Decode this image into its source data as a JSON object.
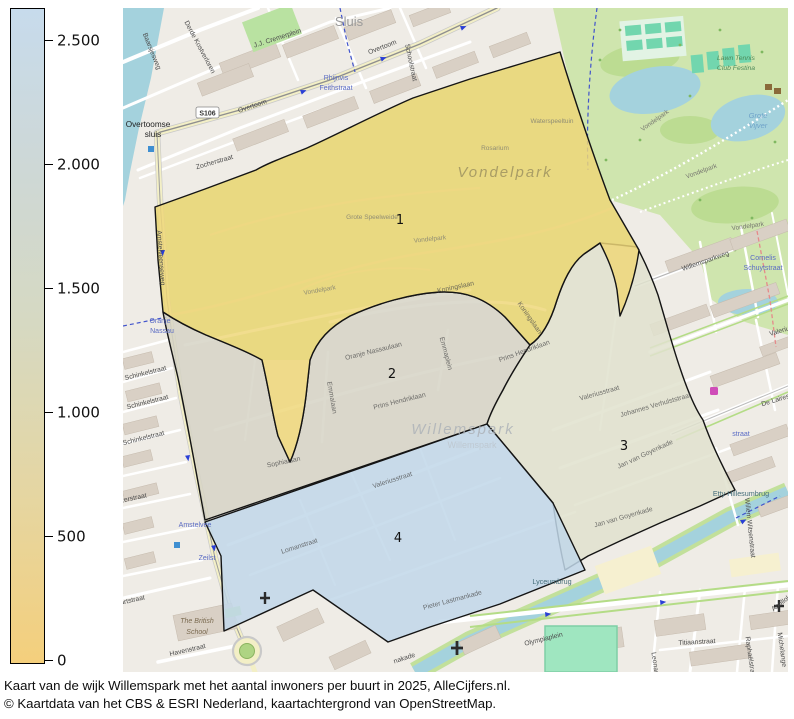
{
  "legend": {
    "min": 0,
    "max": 2500,
    "ticks": [
      {
        "label": "2.500"
      },
      {
        "label": "2.000"
      },
      {
        "label": "1.500"
      },
      {
        "label": "1.000"
      },
      {
        "label": "500"
      },
      {
        "label": "0"
      }
    ],
    "gradient_top_color": "#c7dbec",
    "gradient_bottom_color": "#f4cf7c"
  },
  "caption": {
    "line1": "Kaart van de wijk Willemspark met het aantal inwoners per buurt in 2025, AlleCijfers.nl.",
    "line2": "© Kaartdata van het CBS & ESRI Nederland, kaartachtergrond van OpenStreetMap."
  },
  "regions": {
    "r1": {
      "number": "1",
      "color": "#eed878"
    },
    "r2": {
      "number": "2",
      "color": "#d6d4c5"
    },
    "r3": {
      "number": "3",
      "color": "#e0e2ce"
    },
    "r4": {
      "number": "4",
      "color": "#c1d7e9"
    }
  },
  "map": {
    "shields": {
      "s106": "S106"
    },
    "labels": {
      "sluis": "Sluis",
      "overtoomse_sluis_1": "Overtoomse",
      "overtoomse_sluis_2": "sluis",
      "overtoom_a": "Overtoom",
      "overtoom_b": "Overtoom",
      "rhijnvis_1": "Rhijnvis",
      "rhijnvis_2": "Feithstraat",
      "jj_cremerplein": "J.J. Cremerplein",
      "baarsjesweg": "Baarsjesweg",
      "derde_kostverloren": "Derde Kostverloren",
      "schoolstraat": "Schoolstraat",
      "zocherstraat": "Zocherstraat",
      "amstelveenseweg": "Amstelveenseweg",
      "schinkelstraat_1": "Schinkelstraat",
      "schinkelstraat_2": "Schinkelstraat",
      "schinkelstraat_3": "Schinkelstraat",
      "zerstraat": "zerstraat",
      "oranje_1": "Oranje",
      "nassau_2": "Nassau",
      "amstelveen_blue": "Amstelvee",
      "zeilstraat": "Zeilst",
      "british_1": "The British",
      "british_2": "School",
      "havenstraat": "Havenstraat",
      "artstraat": "artstraat",
      "nakade": "nakade",
      "olympiaplein": "Olympiaplein",
      "titiaanstraat": "Titiaanstraat",
      "raphaelstraat": "Raphaëlstra",
      "michelangelostraat": "Michelange",
      "apollolaan": "Apollola",
      "leonardostraat": "Leonar",
      "willem_witsenstraat": "Willem Witsenstraat",
      "etty_hillesumbrug": "Etty Hillesumbrug",
      "lyceumbrug": "Lyceumbrug",
      "jan_van_goyenkade_1": "Jan van Goyenkade",
      "jan_van_goyenkade_2": "Jan van Goyenkade",
      "willemsparkweg": "Willemsparkweg",
      "cornelis_1": "Cornelis",
      "cornelis_2": "Schuytstraat",
      "valeriusstraat_r": "Valeriu",
      "de_lairessestraat": "De Laires",
      "emmastraat": "straat",
      "vondelpark_big": "Vondelpark",
      "vondelpark_p1": "Vondelpark",
      "vondelpark_p2": "Vondelpark",
      "vondelpark_p3": "Vondelpark",
      "vondelpark_p4": "Vondelpark",
      "vondelpark_p5": "Vondelpark",
      "grote_vijver_1": "Grote",
      "grote_vijver_2": "Vijver",
      "lawn_tennis_1": "Lawn Tennis",
      "lawn_tennis_2": "Club Festina",
      "rosarium": "Rosarium",
      "waterspeeltuin": "Waterspeeltuin",
      "grote_speelweide": "Grote Speelweide",
      "willemspark_big": "Willemspark",
      "willemspark_small": "Willemspark",
      "koningslaan_1": "Koningslaan",
      "koningslaan_2": "Koningslaan",
      "emmalaan": "Emmalaan",
      "oranje_nassaulaan": "Oranje Nassaulaan",
      "prins_hendriklaan_1": "Prins Hendriklaan",
      "prins_hendriklaan_2": "Prins Hendriklaan",
      "emmaplein": "Emmaplein",
      "valeriusstraat_3": "Valeriusstraat",
      "johannes_verhulststraat": "Johannes Verhulststraat",
      "valeriusstraat_4": "Valeriusstraat",
      "lomanstraat": "Lomanstraat",
      "pieter_lastmankade": "Pieter Lastmankade",
      "sophialaan": "Sophialaan"
    }
  }
}
